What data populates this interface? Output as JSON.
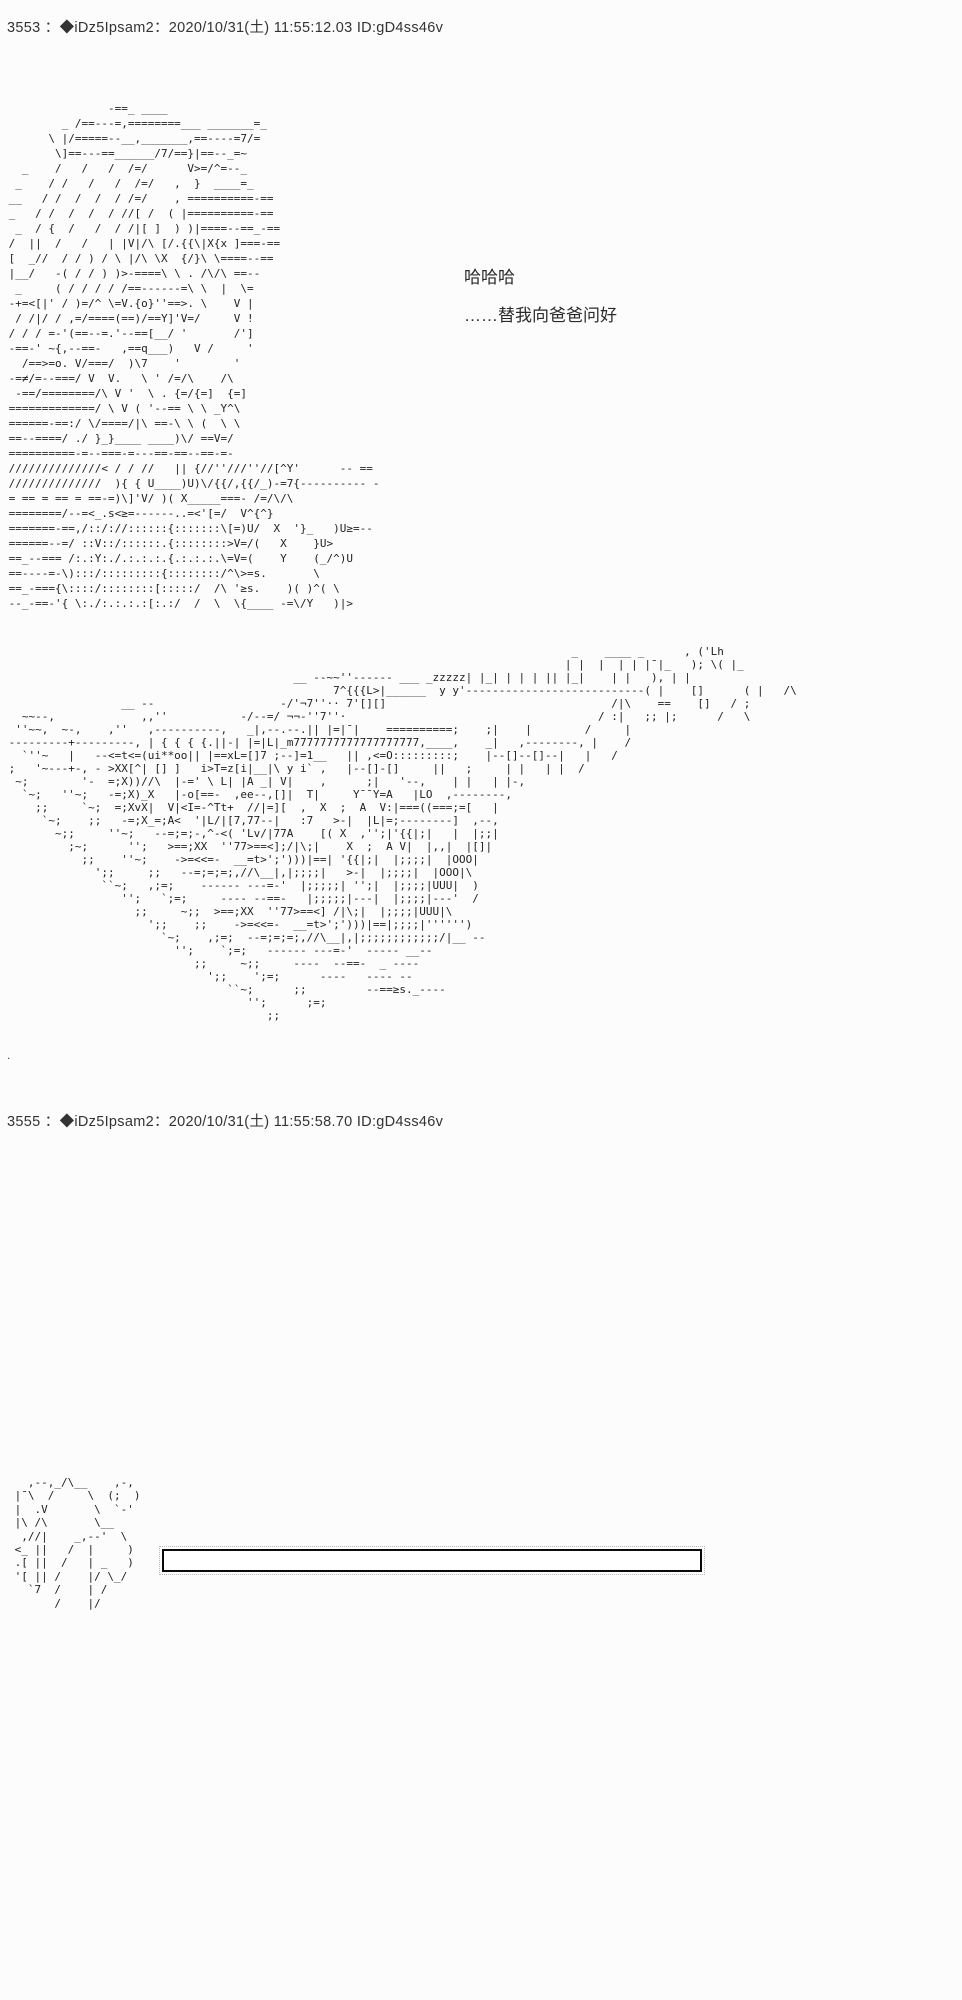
{
  "page": {
    "background": "#fcfcfc",
    "ink_color": "#1f1f1f",
    "box_border_color": "#0a0a0a"
  },
  "posts": [
    {
      "number": "3553",
      "tripcode": "◆iDz5Ipsam2",
      "datetime": "2020/10/31(土) 11:55:12.03",
      "id": "ID:gD4ss46v",
      "header": "3553 ：◆iDz5Ipsam2：2020/10/31(土) 11:55:12.03 ID:gD4ss46v",
      "dialogue": [
        "哈哈哈",
        "……替我向爸爸问好"
      ],
      "trailing_dot": ".",
      "aa_character": [
        "                -==_ ____",
        "         _ /==---=,========___ _______=_",
        "       \\ |/=====--__,_______,==----=7/=",
        "        \\]==---==______/7/==}|==--_=~",
        "   _    /   /   /  /=/      V>=/^=--_",
        "  _    / /   /   /  /=/   ,  }  ____=_",
        " __   / /  /  /  / /=/    , ==========-==",
        " _   / /  /  /  / //[ /  ( |==========-==",
        "  _  / {  /   /  / /|[ ]  ) )|====--==_-==",
        " /  ||  /   /   | |V|/\\ [/.{{\\|X{x ]===-==",
        " [  _//  / / ) / \\ |/\\ \\X  {/}\\ \\====--==",
        " |__/   -( / / ) )>-====\\ \\ . /\\/\\ ==--",
        "  _     ( / / / / /==------=\\ \\  |  \\=",
        " -+=<[|' / )=/^ \\=V.{o}''==>. \\    V |",
        "  / /|/ / ,=/====(==)/==Y]'V=/     V !",
        " / / / =-'(==--=.'--==[__/ '       /']",
        " -==-' ~{,--==-   ,==q___)   V /     '",
        "   /==>=o. V/===/  )\\7    '        '",
        " -=≠/=--===/ V  V.   \\ ' /=/\\    /\\",
        "  -==/========/\\ V '  \\ . {=/{=]  {=]",
        " =============/ \\ V ( '--== \\ \\ _Y^\\",
        " ======-==:/ \\/====/|\\ ==-\\ \\ (  \\ \\",
        " ==--====/ ./ }_}____ ____)\\/ ==V=/",
        " ==========-=--===-=---==-==--==-=-",
        " //////////////< / / //   || {//''///''//[^Y'      -- ==",
        " //////////////  ){ { U____)U)\\/{{/,{{/_)-=7{---------- -",
        " = == = == = ==-=)\\]'V/ )( X_____===- /=/\\/\\",
        " ========/--=<_.s<≥=------..=<'[=/  V^{^}",
        " =======-==,/::/://::::::{:::::::\\[=)U/  X  '}_   )U≥=--",
        " ======--=/ ::V::/::::::.{::::::::>V=/(   X    }U>",
        " ==_--=== /:.:Y:./.:.:.:.{.:.:.:.\\=V=(    Y    (_/^)U",
        " ==----=-\\):::/:::::::::{::::::::/^\\>=s.       \\",
        " ==_-==={\\::::/::::::::[:::::/  /\\ '≥s.    )( )^( \\",
        " --_-==-'{ \\:./:.:.:.:[:.:/  /  \\  \\{____ -=\\/Y   )|>"
      ],
      "aa_train": [
        "                                                                                      _    ____ _      , ('Lh",
        "                                                                                     | |  |  | | |¯|_   ); \\( |_",
        "                                            __ --~~''------ ___ _zzzzz| |_| | | | || |_|    | |   ), | |",
        "                                                  7^{{{L>|______  y y'---------------------------( |    []      ( |   /\\",
        "                  __ --                   -/'¬7''·· 7'[][]                                  /|\\    ==    []   / ;",
        "   ~~--,             ,,''           -/--=/ ¬¬-''7''·                                      / :|   ;; |;      /   \\",
        "  ''~~,  ~-,    ,''   ,----------,   _|,--.--.|| |=|¯|    ==========;    ;|    |        /     |",
        " ---------+---------, | { { { {.||-| |=|L|_m7777777777777777777,____,    _|   ,--------, |    /",
        "   `''~   |   --<=t<=(ui**oo|| |==xL=[]7 ;--]=1__   || ,<=O:::::::::;    |--[]--[]--|   |   /",
        " ;   '~---+-, - >XX[^| [] ]   i>T=z[i|__|\\ y i` ,   |--[]-[]     ||   ;     | |   | |  /",
        "  ~;        '-  =;X))//\\  |-=' \\ L| |A _| V|    ,      ;|   '--,    | |   | |-,",
        "   `~;   ''~;   -=;X)_X   |-o[==-  ,ee--,[]|  T|     Y¯¯Y=A   |LO  ,--------,",
        "     ;;     `~;  =;XvX|  V|<I=-^Tt+  //|=][  ,  X  ;  A  V:|===((===;=[   |",
        "      `~;    ;;   -=;X_=;A<  '|L/|[7,77--|   :7   >-|  |L|=;--------]  ,--,",
        "        ~;;     ''~;   --=;=;-,^-<( 'Lv/|77A    [( X  ,'';|'{{|;|   |  |;;|",
        "          ;~;      '';   >==;XX  ''77>==<];/|\\;|    X  ;  A V|  |,,|  |[]|",
        "            ;;    ''~;    ->=<<=-  __=t>';')))|==| '{{|;|  |;;;;|  |OOO|",
        "              ';;     ;;   --=;=;=;,//\\__|,|;;;;|   >-|  |;;;;|  |OOO|\\",
        "               ``~;   ,;=;    ------ ---=-'  |;;;;;| '';|  |;;;;|UUU|  )",
        "                  '';   `;=;     ---- --==-   |;;;;;|---|  |;;;;|---'  /",
        "                    ;;     ~;;  >==;XX  ''77>==<] /|\\;|  |;;;;|UUU|\\",
        "                      ';;    ;;    ->=<<=-  __=t>';')))|==|;;;;|'''''')",
        "                        `~;    ,;=;  --=;=;=;,//\\__|,|;;;;;;;;;;;;/|__ --",
        "                          '';    `;=;   ------ ---=-'  ----- __--",
        "                             ;;     ~;;     ----  --==-  _ ----",
        "                               ';;    ';=;      ----   ---- --",
        "                                  ``~;      ;;         --==≥s._----",
        "                                     '';      ;=;",
        "                                        ;;",
        ""
      ]
    },
    {
      "number": "3555",
      "tripcode": "◆iDz5Ipsam2",
      "datetime": "2020/10/31(土) 11:55:58.70",
      "id": "ID:gD4ss46v",
      "header": "3555 ：◆iDz5Ipsam2：2020/10/31(土) 11:55:58.70 ID:gD4ss46v",
      "aa_mascot": [
        "   ,--,_/\\__    ,-,",
        " |¯\\  /     \\  (;  )",
        " |  .V       \\  `-'",
        " |\\ /\\       \\__",
        "  ,//|    _,--'  \\",
        " <_ ||   /  |     )",
        " .[ ||  /   | _   )",
        " '[ || /    |/ \\_/",
        "   `7  /    | /",
        "       /    |/"
      ]
    }
  ]
}
